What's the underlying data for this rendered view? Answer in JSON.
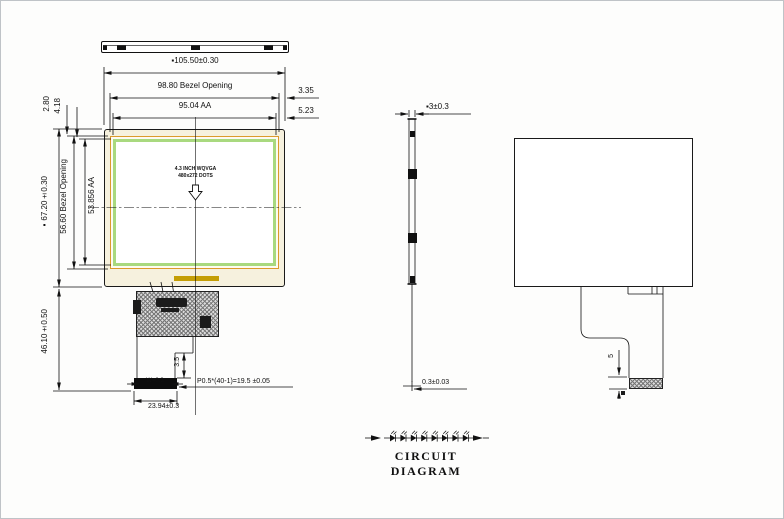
{
  "drawing_title": "CIRCUIT DIAGRAM",
  "colors": {
    "line": "#1a1a1a",
    "bezel_line": "#dc9a2c",
    "active_area_band": "#a9d97f",
    "panel_fill": "#f6f1de",
    "gold_bar": "#c49e06"
  },
  "front_view": {
    "top_dimensions": {
      "overall_width": "▪105.50±0.30",
      "bezel_opening_width": "98.80 Bezel Opening",
      "active_area_width": "95.04 AA",
      "right_offset_bezel": "3.35",
      "right_offset_aa": "5.23"
    },
    "left_dimensions": {
      "top_offset_bezel": "2.80",
      "top_offset_aa": "4.18",
      "overall_height": "▪67.20±0.30",
      "bezel_opening_height": "56.60 Bezel Opening",
      "active_area_height": "53.856 AA",
      "fpc_length": "46.10±0.50"
    },
    "panel_label": {
      "line1": "4.3 INCH WQVGA",
      "line2": "480x272 DOTS"
    },
    "fpc_dimensions": {
      "stiffener_length": "3.5",
      "contact_width": "W=0.3",
      "pin_pitch": "P0.5*(40-1)=19.5 ±0.05",
      "connector_width": "23.94±0.3"
    }
  },
  "side_view": {
    "thickness": "▪3±0.3",
    "fpc_thickness": "0.3±0.03"
  },
  "back_view": {
    "fpc_tail_length": "5"
  },
  "circuit_diagram": {
    "title": "CIRCUIT DIAGRAM",
    "led_count": 8
  }
}
